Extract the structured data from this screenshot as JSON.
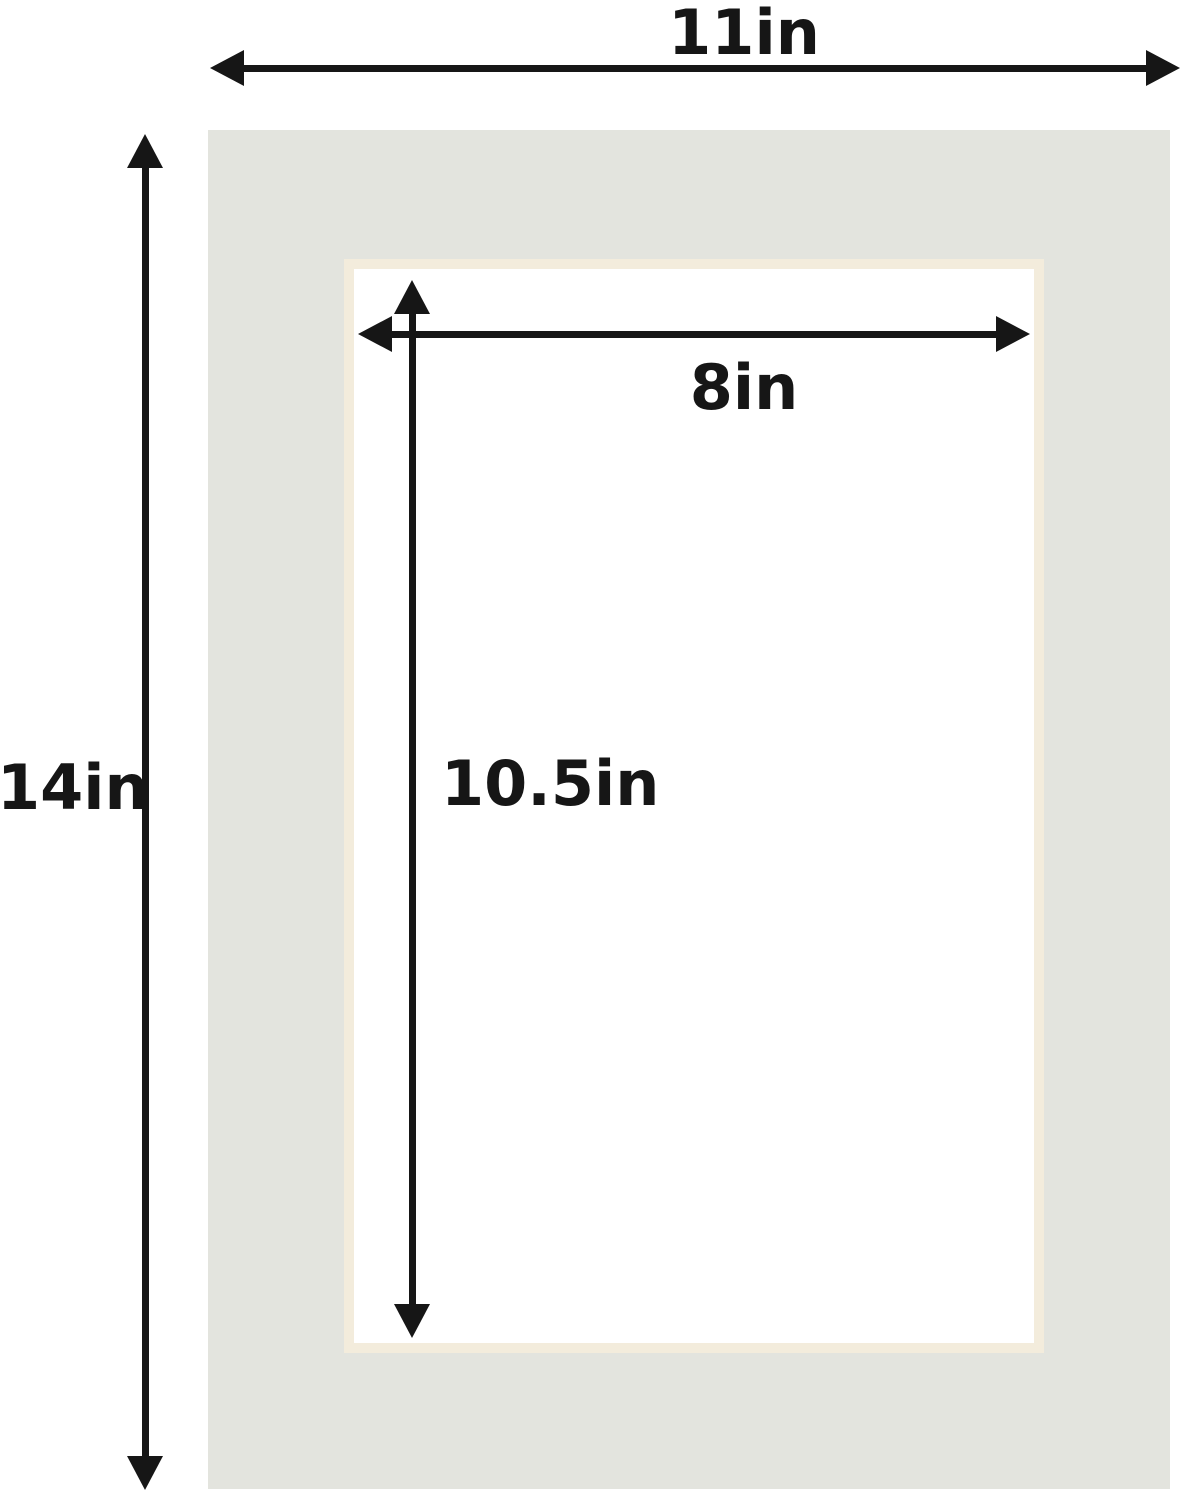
{
  "diagram": {
    "outer": {
      "width_label": "11in",
      "height_label": "14in"
    },
    "opening": {
      "width_label": "8in",
      "height_label": "10.5in"
    },
    "colors": {
      "background": "#ffffff",
      "mat": "#e3e4de",
      "bevel": "#f3ecdc",
      "opening": "#ffffff",
      "arrow": "#161616"
    }
  }
}
